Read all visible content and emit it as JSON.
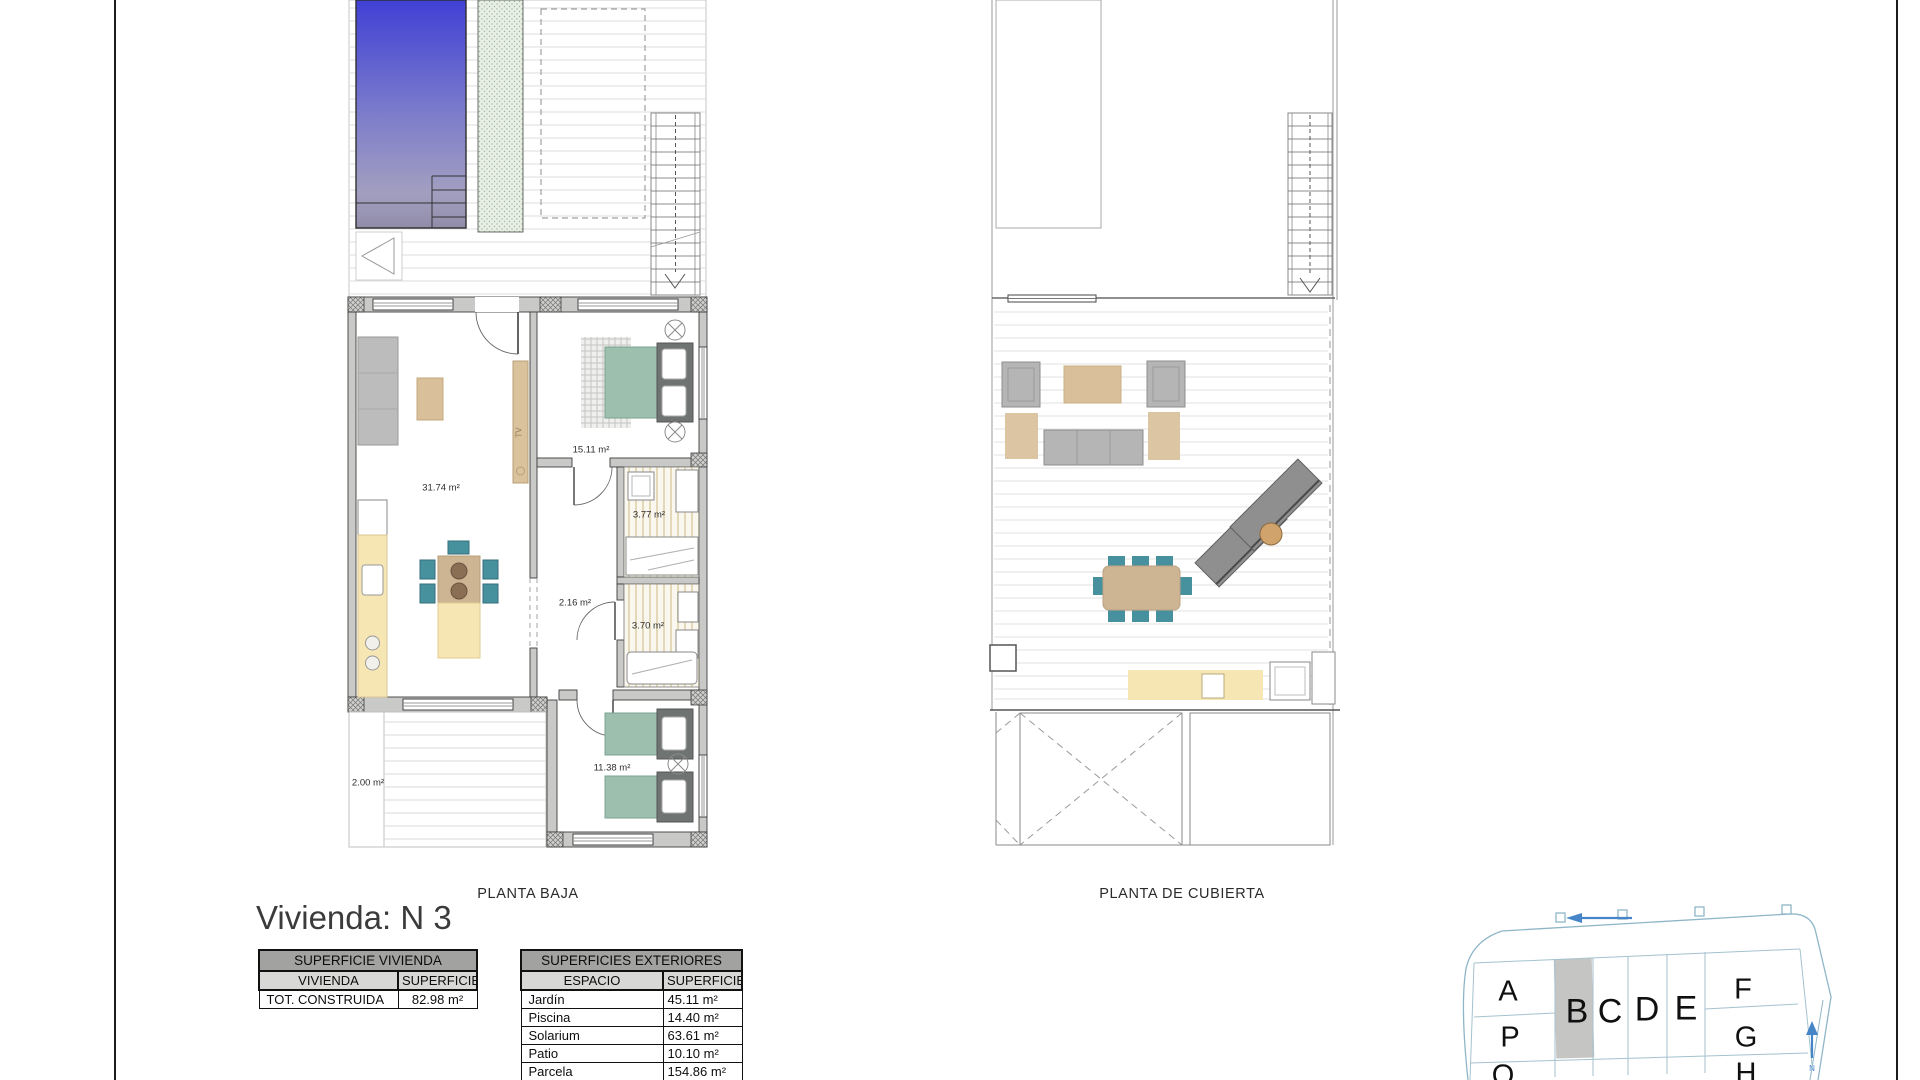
{
  "title": "Vivienda: N 3",
  "plans": {
    "baja_label": "PLANTA BAJA",
    "cubierta_label": "PLANTA DE CUBIERTA"
  },
  "room_labels": {
    "living": "31.74 m²",
    "bedroom_main": "15.11 m²",
    "bath_1": "3.77 m²",
    "hall": "2.16 m²",
    "bath_2": "3.70 m²",
    "bedroom_2": "11.38 m²",
    "patio": "2.00 m²",
    "tv": "TV"
  },
  "tables": {
    "vivienda": {
      "title": "SUPERFICIE VIVIENDA",
      "columns": [
        "VIVIENDA",
        "SUPERFICIE"
      ],
      "rows": [
        {
          "label": "TOT. CONSTRUIDA",
          "value": "82.98 m²"
        }
      ]
    },
    "exteriores": {
      "title": "SUPERFICIES EXTERIORES",
      "columns": [
        "ESPACIO",
        "SUPERFICIE"
      ],
      "rows": [
        {
          "label": "Jardín",
          "value": "45.11 m²"
        },
        {
          "label": "Piscina",
          "value": "14.40 m²"
        },
        {
          "label": "Solarium",
          "value": "63.61 m²"
        },
        {
          "label": "Patio",
          "value": "10.10 m²"
        },
        {
          "label": "Parcela",
          "value": "154.86 m²"
        }
      ]
    }
  },
  "site_plan": {
    "highlighted_plot": "B",
    "north_label": "N",
    "plots": {
      "a": "A",
      "b": "B",
      "c": "C",
      "d": "D",
      "e": "E",
      "f": "F",
      "p": "P",
      "g": "G",
      "q": "Q",
      "h": "H"
    },
    "colors": {
      "outline": "#8fb6c8",
      "highlight": "#c5c5c3",
      "arrow": "#4585c8"
    }
  },
  "colors": {
    "wall": "#c9c9c7",
    "pool_top": "#4040d6",
    "teal_furniture": "#47919f",
    "bed_green": "#9dbfae",
    "kitchen_yellow": "#f6e6b4",
    "tan": "#d9c09b"
  }
}
